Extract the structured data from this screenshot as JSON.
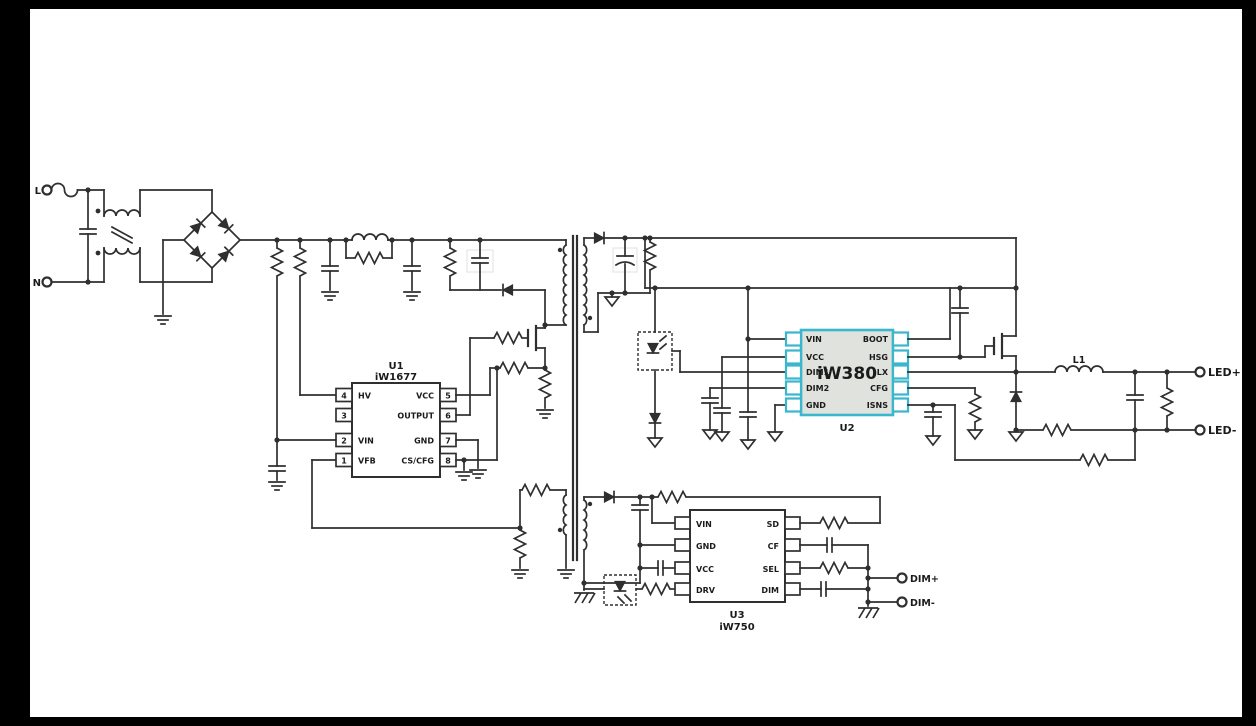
{
  "colors": {
    "background": "#000000",
    "sheet": "#ffffff",
    "wire": "#2f2f2f",
    "accent": "#3ab6cd",
    "ic_fill": "#dfe2dd"
  },
  "terminals": {
    "line": "L",
    "neutral": "N",
    "led_plus": "LED+",
    "led_minus": "LED-",
    "dim_plus": "DIM+",
    "dim_minus": "DIM-"
  },
  "labels": {
    "inductor": "L1"
  },
  "u1": {
    "ref": "U1",
    "part": "iW1677",
    "left_pins": [
      {
        "num": "4",
        "name": "HV"
      },
      {
        "num": "3",
        "name": ""
      },
      {
        "num": "2",
        "name": "VIN"
      },
      {
        "num": "1",
        "name": "VFB"
      }
    ],
    "right_pins": [
      {
        "num": "5",
        "name": "VCC"
      },
      {
        "num": "6",
        "name": "OUTPUT"
      },
      {
        "num": "7",
        "name": "GND"
      },
      {
        "num": "8",
        "name": "CS/CFG"
      }
    ]
  },
  "u2": {
    "ref": "U2",
    "part": "iW380",
    "left_pins": [
      "VIN",
      "VCC",
      "DIM1",
      "DIM2",
      "GND"
    ],
    "right_pins": [
      "BOOT",
      "HSG",
      "LX",
      "CFG",
      "ISNS"
    ]
  },
  "u3": {
    "ref": "U3",
    "part": "iW750",
    "left_pins": [
      "VIN",
      "GND",
      "VCC",
      "DRV"
    ],
    "right_pins": [
      "SD",
      "CF",
      "SEL",
      "DIM"
    ]
  }
}
